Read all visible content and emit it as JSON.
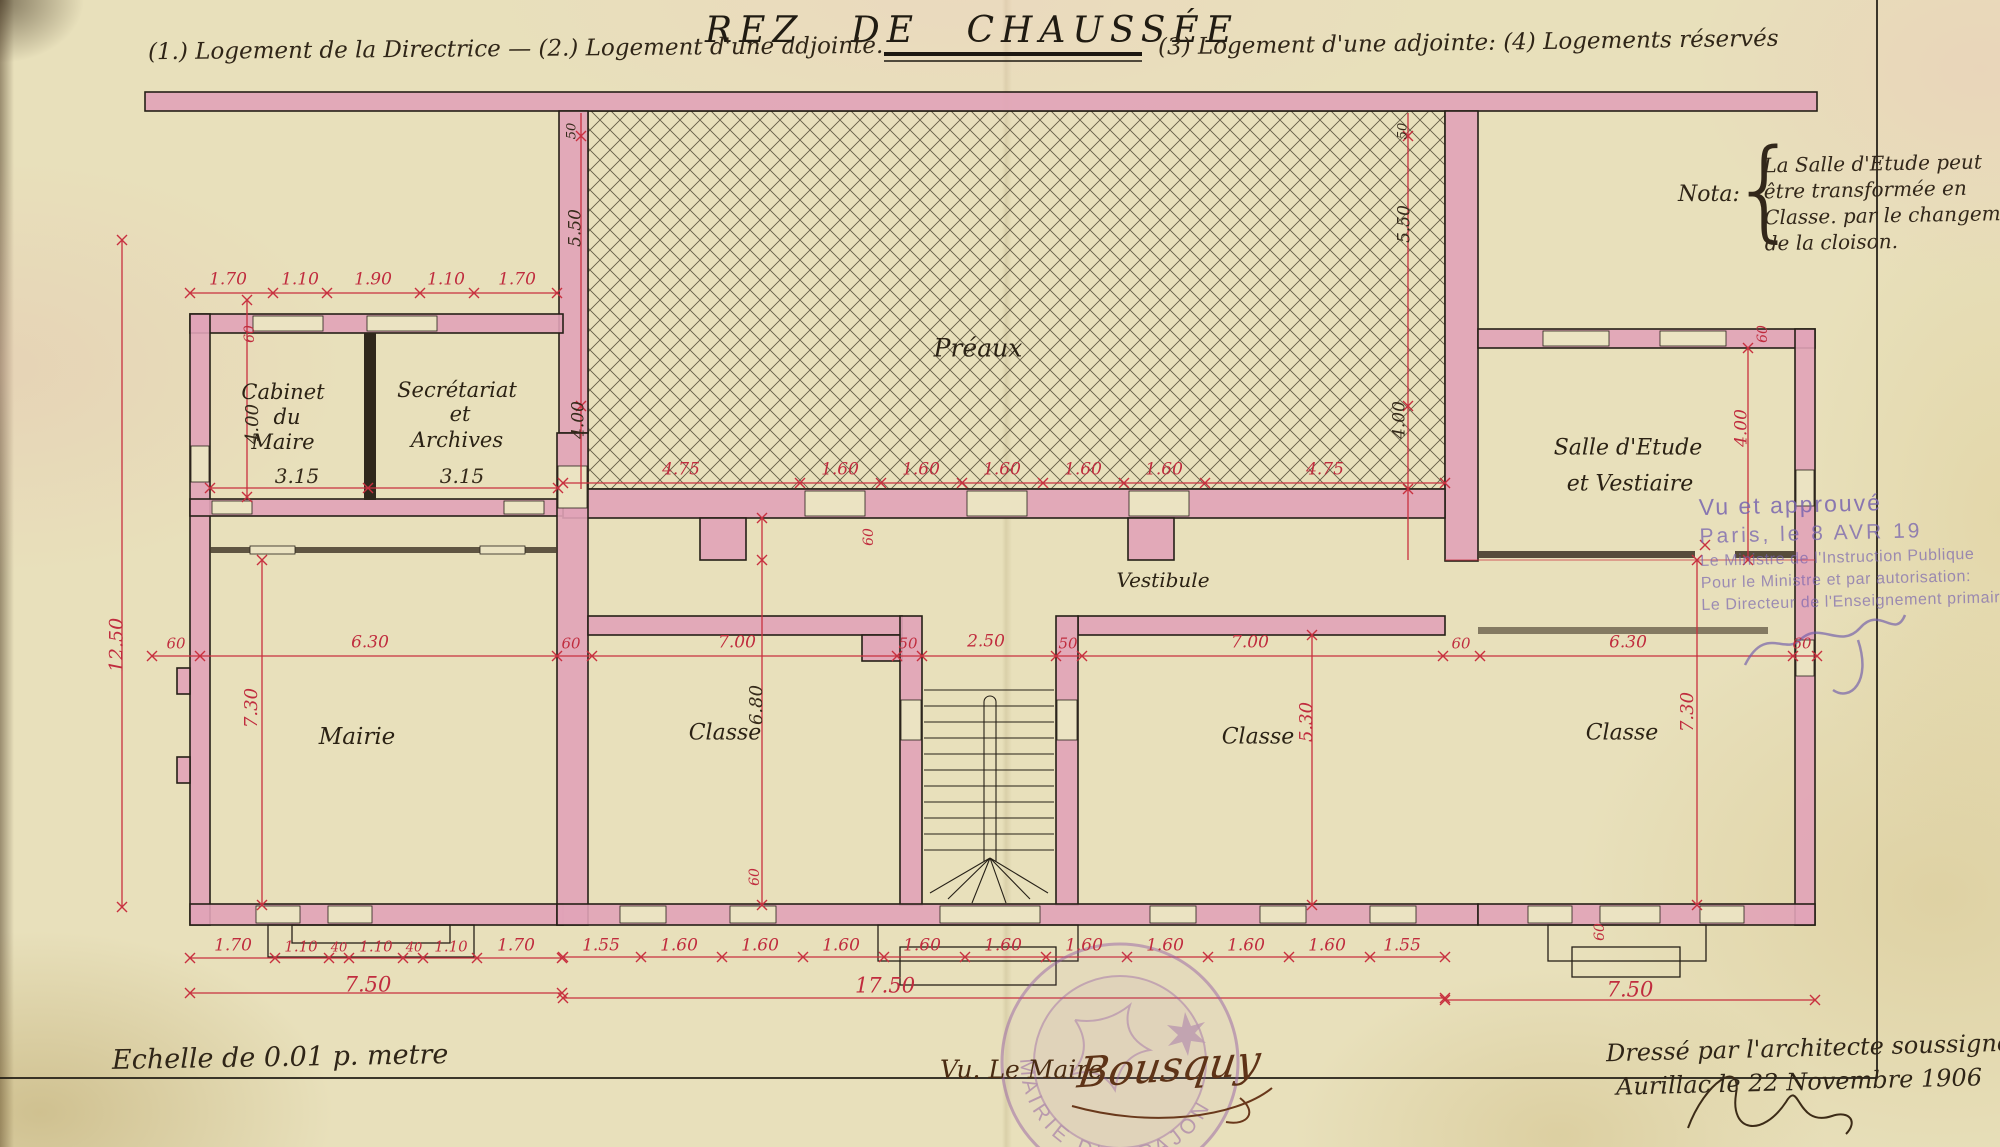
{
  "title": "REZ DE CHAUSSÉE",
  "legend": {
    "left": "(1.) Logement de la Directrice — (2.) Logement d'une adjointe.",
    "right": "(3) Logement d'une adjointe: (4) Logements réservés"
  },
  "nota": {
    "label": "Nota:",
    "brace": "{",
    "lines": [
      "La Salle d'Etude peut",
      "être transformée en",
      "Classe. par le changement",
      "de la cloison."
    ]
  },
  "rooms": {
    "cabinet": [
      "Cabinet",
      "du",
      "Maire"
    ],
    "secretariat": [
      "Secrétariat",
      "et",
      "Archives"
    ],
    "preau": "Préaux",
    "salle_etude": [
      "Salle d'Etude",
      "et Vestiaire"
    ],
    "vestibule": "Vestibule",
    "mairie": "Mairie",
    "classe1": "Classe",
    "classe2": "Classe",
    "classe3": "Classe"
  },
  "stamps": {
    "mairie_arc": "MAIRIE D'ARPAJON",
    "approval_lines": [
      "Vu et approuvé",
      "Paris, le  8 AVR 19",
      "Le Ministre de l'Instruction Publique",
      "Pour le Ministre et par autorisation:",
      "Le Directeur de l'Enseignement primaire"
    ]
  },
  "footer": {
    "scale": "Echelle de 0.01 p. metre",
    "mayor_label": "Vu. Le Maire",
    "mayor_signature": "Bousquy",
    "architect_line1": "Dressé par l'architecte soussigné",
    "architect_line2": "Aurillac le 22 Novembre 1906"
  },
  "dim_labels": [
    {
      "t": "1.70",
      "x": 228,
      "y": 280
    },
    {
      "t": "1.10",
      "x": 300,
      "y": 280
    },
    {
      "t": "1.90",
      "x": 373,
      "y": 280
    },
    {
      "t": "1.10",
      "x": 446,
      "y": 280
    },
    {
      "t": "1.70",
      "x": 517,
      "y": 280
    },
    {
      "t": "60",
      "x": 250,
      "y": 334,
      "r": -90,
      "s": 14
    },
    {
      "t": "12.50",
      "x": 117,
      "y": 645,
      "r": -90,
      "s": 19
    },
    {
      "t": "4.00",
      "x": 253,
      "y": 424,
      "r": -90,
      "c": "k",
      "s": 18
    },
    {
      "t": "3.15",
      "x": 297,
      "y": 476,
      "c": "k",
      "s": 20
    },
    {
      "t": "3.15",
      "x": 462,
      "y": 476,
      "c": "k",
      "s": 20
    },
    {
      "t": "50",
      "x": 572,
      "y": 131,
      "r": -90,
      "c": "k",
      "s": 13
    },
    {
      "t": "5.50",
      "x": 576,
      "y": 228,
      "r": -90,
      "c": "k",
      "s": 17
    },
    {
      "t": "4.00",
      "x": 579,
      "y": 420,
      "r": -90,
      "c": "k",
      "s": 17
    },
    {
      "t": "50",
      "x": 1403,
      "y": 131,
      "r": -90,
      "c": "k",
      "s": 13
    },
    {
      "t": "5.50",
      "x": 1405,
      "y": 224,
      "r": -90,
      "c": "k",
      "s": 17
    },
    {
      "t": "4.00",
      "x": 1400,
      "y": 420,
      "r": -90,
      "c": "k",
      "s": 17
    },
    {
      "t": "4.75",
      "x": 681,
      "y": 470
    },
    {
      "t": "1.60",
      "x": 840,
      "y": 470
    },
    {
      "t": "1.60",
      "x": 921,
      "y": 470
    },
    {
      "t": "1.60",
      "x": 1002,
      "y": 470
    },
    {
      "t": "1.60",
      "x": 1083,
      "y": 470
    },
    {
      "t": "1.60",
      "x": 1164,
      "y": 470
    },
    {
      "t": "4.75",
      "x": 1325,
      "y": 470
    },
    {
      "t": "60",
      "x": 869,
      "y": 537,
      "r": -90,
      "s": 14
    },
    {
      "t": "60",
      "x": 176,
      "y": 644,
      "s": 15
    },
    {
      "t": "6.30",
      "x": 370,
      "y": 643
    },
    {
      "t": "60",
      "x": 571,
      "y": 644,
      "s": 15
    },
    {
      "t": "7.00",
      "x": 737,
      "y": 643
    },
    {
      "t": "50",
      "x": 908,
      "y": 644,
      "s": 15
    },
    {
      "t": "2.50",
      "x": 986,
      "y": 642
    },
    {
      "t": "50",
      "x": 1068,
      "y": 644,
      "s": 15
    },
    {
      "t": "7.00",
      "x": 1250,
      "y": 643
    },
    {
      "t": "60",
      "x": 1461,
      "y": 644,
      "s": 15
    },
    {
      "t": "6.30",
      "x": 1628,
      "y": 643
    },
    {
      "t": "60",
      "x": 1802,
      "y": 644,
      "s": 15
    },
    {
      "t": "7.30",
      "x": 252,
      "y": 708,
      "r": -90,
      "s": 18
    },
    {
      "t": "6.80",
      "x": 757,
      "y": 705,
      "r": -90,
      "c": "k",
      "s": 18
    },
    {
      "t": "60",
      "x": 755,
      "y": 877,
      "r": -90,
      "s": 14
    },
    {
      "t": "5.30",
      "x": 1307,
      "y": 722,
      "r": -90,
      "s": 18
    },
    {
      "t": "7.30",
      "x": 1688,
      "y": 712,
      "r": -90,
      "s": 18
    },
    {
      "t": "4.00",
      "x": 1742,
      "y": 428,
      "r": -90,
      "s": 17
    },
    {
      "t": "60",
      "x": 1763,
      "y": 334,
      "r": -90,
      "s": 14
    },
    {
      "t": "1.70",
      "x": 233,
      "y": 946
    },
    {
      "t": "1.10",
      "x": 301,
      "y": 947,
      "s": 15
    },
    {
      "t": "40",
      "x": 339,
      "y": 948,
      "s": 13
    },
    {
      "t": "1.10",
      "x": 376,
      "y": 947,
      "s": 15
    },
    {
      "t": "40",
      "x": 414,
      "y": 948,
      "s": 13
    },
    {
      "t": "1.10",
      "x": 451,
      "y": 947,
      "s": 15
    },
    {
      "t": "1.70",
      "x": 516,
      "y": 946
    },
    {
      "t": "7.50",
      "x": 368,
      "y": 985,
      "s": 21
    },
    {
      "t": "1.55",
      "x": 601,
      "y": 946
    },
    {
      "t": "1.60",
      "x": 679,
      "y": 946
    },
    {
      "t": "1.60",
      "x": 760,
      "y": 946
    },
    {
      "t": "1.60",
      "x": 841,
      "y": 946
    },
    {
      "t": "1.60",
      "x": 922,
      "y": 946
    },
    {
      "t": "1.60",
      "x": 1003,
      "y": 946
    },
    {
      "t": "1.60",
      "x": 1084,
      "y": 946
    },
    {
      "t": "1.60",
      "x": 1165,
      "y": 946
    },
    {
      "t": "1.60",
      "x": 1246,
      "y": 946
    },
    {
      "t": "1.60",
      "x": 1327,
      "y": 946
    },
    {
      "t": "1.55",
      "x": 1402,
      "y": 946
    },
    {
      "t": "17.50",
      "x": 885,
      "y": 986,
      "s": 21
    },
    {
      "t": "7.50",
      "x": 1630,
      "y": 990,
      "s": 21
    },
    {
      "t": "60",
      "x": 1600,
      "y": 932,
      "r": -90,
      "s": 14
    }
  ]
}
